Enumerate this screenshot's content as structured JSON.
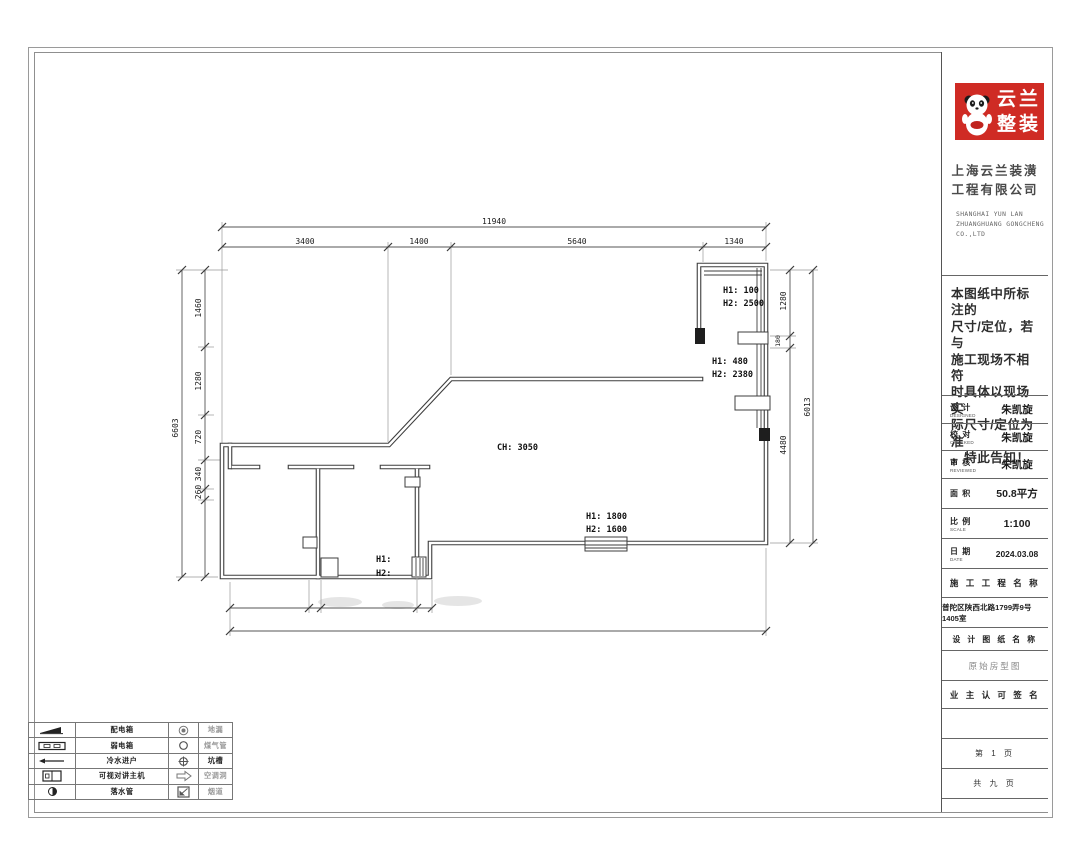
{
  "title_block": {
    "logo": {
      "brand_line1": "云兰",
      "brand_line2": "整装"
    },
    "company_cn_line1": "上海云兰装潢",
    "company_cn_line2": "工程有限公司",
    "company_en_line1": "SHANGHAI YUN LAN",
    "company_en_line2": "ZHUANGHUANG GONGCHENG",
    "company_en_line3": "CO.,LTD",
    "notice_line1": "本图纸中所标注的",
    "notice_line2": "尺寸/定位，若与",
    "notice_line3": "施工现场不相符",
    "notice_line4": "时具体以现场实",
    "notice_line5": "际尺寸/定位为准",
    "notice_line6": "，特此告知！",
    "fields": [
      {
        "label": "设 计",
        "sub": "DESIGNED",
        "value": "朱凯旋"
      },
      {
        "label": "校 对",
        "sub": "CHECKED",
        "value": "朱凯旋"
      },
      {
        "label": "审 核",
        "sub": "REVIEWED",
        "value": "朱凯旋"
      },
      {
        "label": "面 积",
        "sub": "",
        "value": "50.8平方"
      },
      {
        "label": "比 例",
        "sub": "SCALE",
        "value": "1:100"
      },
      {
        "label": "日 期",
        "sub": "DATE",
        "value": "2024.03.08"
      }
    ],
    "project_name_header": "施 工 工 程 名 称",
    "project_address": "普陀区陕西北路1799弄9号1405室",
    "drawing_name_header": "设 计 图 纸 名 称",
    "drawing_name": "原始房型图",
    "owner_sign_header": "业 主 认 可 签 名",
    "page_current": "第 1 页",
    "page_total": "共 九 页"
  },
  "legend": {
    "rows": [
      {
        "label1": "配电箱",
        "label2": "地漏"
      },
      {
        "label1": "弱电箱",
        "label2": "煤气管"
      },
      {
        "label1": "冷水进户",
        "label2": "坑槽"
      },
      {
        "label1": "可视对讲主机",
        "label2": "空调洞"
      },
      {
        "label1": "落水管",
        "label2": "烟道"
      }
    ]
  },
  "plan": {
    "labels": {
      "ceiling_height": "CH: 3050",
      "bottom_window_h1": "H1: 1800",
      "bottom_window_h2": "H2: 1600",
      "right_top_h1": "H1: 100",
      "right_top_h2": "H2: 2500",
      "right_mid_h1": "H1: 480",
      "right_mid_h2": "H2: 2380",
      "left_opening_h1": "H1:",
      "left_opening_h2": "H2:"
    },
    "dims": {
      "top_overall": "11940",
      "top_segments": [
        "3400",
        "1400",
        "5640",
        "1340"
      ],
      "left_overall": "6603",
      "left_segments": [
        "1460",
        "1280",
        "720",
        "340",
        "260"
      ],
      "right_overall": "6013",
      "right_segments": [
        "1280",
        "180",
        "4480"
      ]
    }
  }
}
